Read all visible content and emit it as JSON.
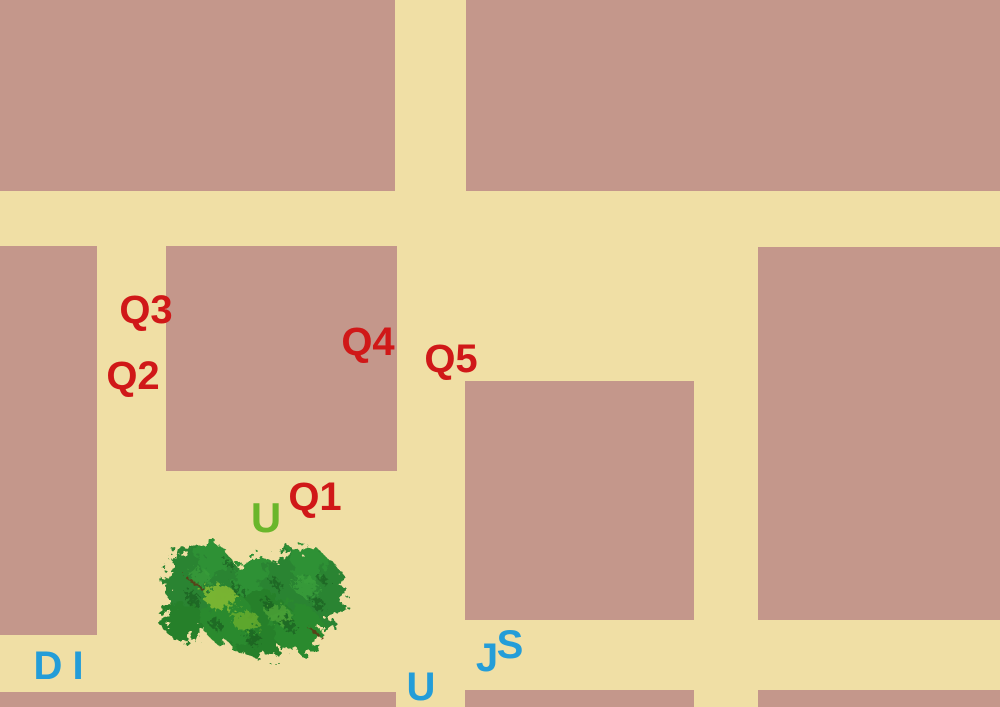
{
  "map": {
    "canvas": {
      "width": 1000,
      "height": 707
    },
    "road_color": "#F0DFA5",
    "block_color": "#C4978B",
    "label_colors": {
      "waypoint_red": "#D01818",
      "letter_blue": "#249DD8",
      "letter_green": "#6AB62B"
    },
    "blocks": [
      {
        "id": "top-left",
        "x": 0,
        "y": 0,
        "w": 395,
        "h": 191
      },
      {
        "id": "top-right",
        "x": 466,
        "y": 0,
        "w": 534,
        "h": 191
      },
      {
        "id": "mid-left",
        "x": 0,
        "y": 246,
        "w": 97,
        "h": 389
      },
      {
        "id": "center",
        "x": 166,
        "y": 246,
        "w": 231,
        "h": 225
      },
      {
        "id": "mid-center",
        "x": 465,
        "y": 381,
        "w": 229,
        "h": 239
      },
      {
        "id": "right",
        "x": 758,
        "y": 247,
        "w": 242,
        "h": 373
      },
      {
        "id": "bottom-left",
        "x": 0,
        "y": 692,
        "w": 396,
        "h": 15
      },
      {
        "id": "bottom-center",
        "x": 465,
        "y": 690,
        "w": 229,
        "h": 17
      },
      {
        "id": "bottom-right",
        "x": 758,
        "y": 690,
        "w": 242,
        "h": 17
      }
    ],
    "labels": [
      {
        "id": "Q1",
        "text": "Q1",
        "color": "#D01818",
        "x": 315,
        "y": 497,
        "font_size": 40
      },
      {
        "id": "Q2",
        "text": "Q2",
        "color": "#D01818",
        "x": 133,
        "y": 376,
        "font_size": 40
      },
      {
        "id": "Q3",
        "text": "Q3",
        "color": "#D01818",
        "x": 146,
        "y": 310,
        "font_size": 40
      },
      {
        "id": "Q4",
        "text": "Q4",
        "color": "#D01818",
        "x": 368,
        "y": 342,
        "font_size": 40
      },
      {
        "id": "Q5",
        "text": "Q5",
        "color": "#D01818",
        "x": 451,
        "y": 359,
        "font_size": 40
      },
      {
        "id": "U-green",
        "text": "U",
        "color": "#6AB62B",
        "x": 266,
        "y": 518,
        "font_size": 42
      },
      {
        "id": "D",
        "text": "D",
        "color": "#249DD8",
        "x": 48,
        "y": 666,
        "font_size": 40
      },
      {
        "id": "I",
        "text": "I",
        "color": "#249DD8",
        "x": 78,
        "y": 666,
        "font_size": 40
      },
      {
        "id": "U-blue",
        "text": "U",
        "color": "#249DD8",
        "x": 421,
        "y": 687,
        "font_size": 40
      },
      {
        "id": "J",
        "text": "J",
        "color": "#249DD8",
        "x": 487,
        "y": 658,
        "font_size": 40
      },
      {
        "id": "S",
        "text": "S",
        "color": "#249DD8",
        "x": 510,
        "y": 645,
        "font_size": 40
      }
    ],
    "tree": {
      "x": 158,
      "y": 529,
      "w": 200,
      "h": 136
    }
  }
}
